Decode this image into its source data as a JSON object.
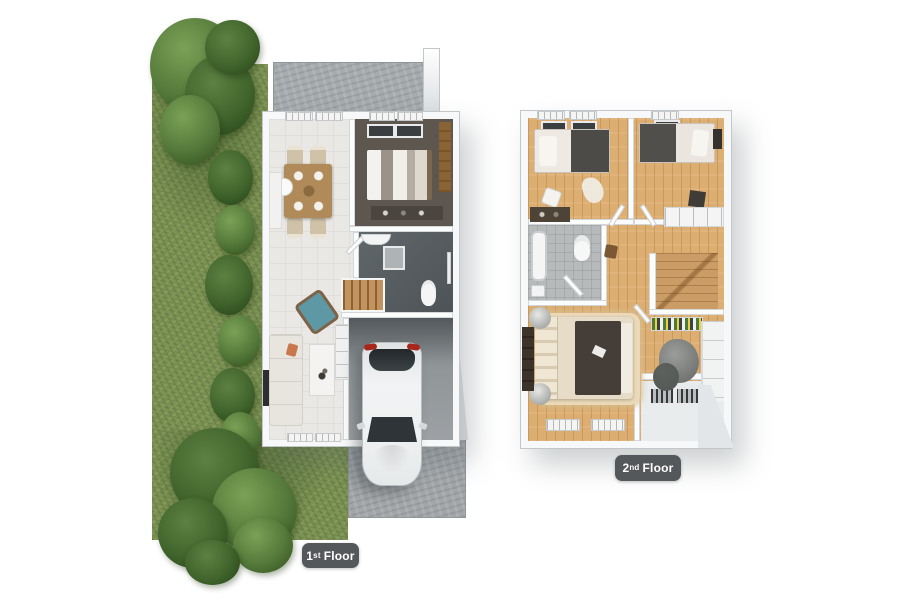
{
  "badges": {
    "first_floor": {
      "number": "1",
      "ordinal": "st",
      "word": "Floor"
    },
    "second_floor": {
      "number": "2",
      "ordinal": "nd",
      "word": "Floor"
    }
  },
  "palette": {
    "page_bg": "#ffffff",
    "grass_green": "#7d9254",
    "tree_green": "#54793a",
    "concrete_gray": "#a6abae",
    "driveway_gray": "#a2a6a9",
    "wall_white": "#f7f8f9",
    "tile_white": "#eae8e4",
    "wood_floor": "#dcae72",
    "stair_wood": "#c2935f",
    "bedroom1_floor": "#5d574f",
    "bath1_floor": "#575e61",
    "bath2_floor": "#b7babb",
    "bed_charcoal": "#453e38",
    "sofa_cream": "#e8e5df",
    "armchair_teal": "#5f98a5",
    "pillow_orange": "#c8784c",
    "table_wood": "#b08a58",
    "car_white": "#f2f3f4",
    "taillight_red": "#a8271c",
    "label_bg": "#55585b",
    "label_text": "#ffffff"
  }
}
